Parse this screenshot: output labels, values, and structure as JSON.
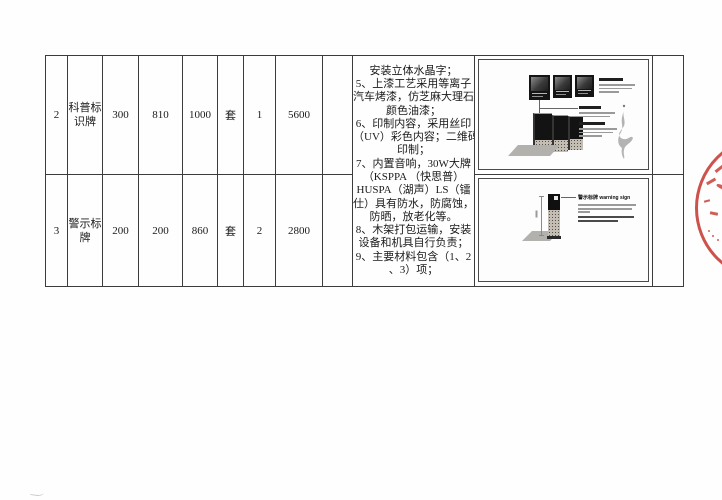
{
  "document": {
    "rows": [
      {
        "cells": [
          "2",
          "科普标识牌",
          "300",
          "810",
          "1000",
          "套",
          "1",
          "5600",
          ""
        ]
      },
      {
        "cells": [
          "3",
          "警示标牌",
          "200",
          "200",
          "860",
          "套",
          "2",
          "2800",
          ""
        ]
      }
    ],
    "notes": "安装立体水晶字；\n5、上漆工艺采用等离子\n汽车烤漆，仿芝麻大理石\n颜色油漆；\n6、印制内容，采用丝印\n（UV）彩色内容；二维码\n印制；\n7、内置音响，30W大牌\n（KSPPA （快思普）\nHUSPA（湖声）LS（镭\n仕）具有防水，防腐蚀，\n防晒，放老化等。\n8、木架打包运输，安装\n设备和机具自行负责；\n9、主要材料包含（1、2\n、3）项；",
    "warning_sign_label": "警示标牌 warning sign"
  },
  "colors": {
    "table_border": "#3c3c3c",
    "stamp_red": "#c4342c",
    "granite": "#c3bdb3",
    "page_background": "#fefefe"
  }
}
